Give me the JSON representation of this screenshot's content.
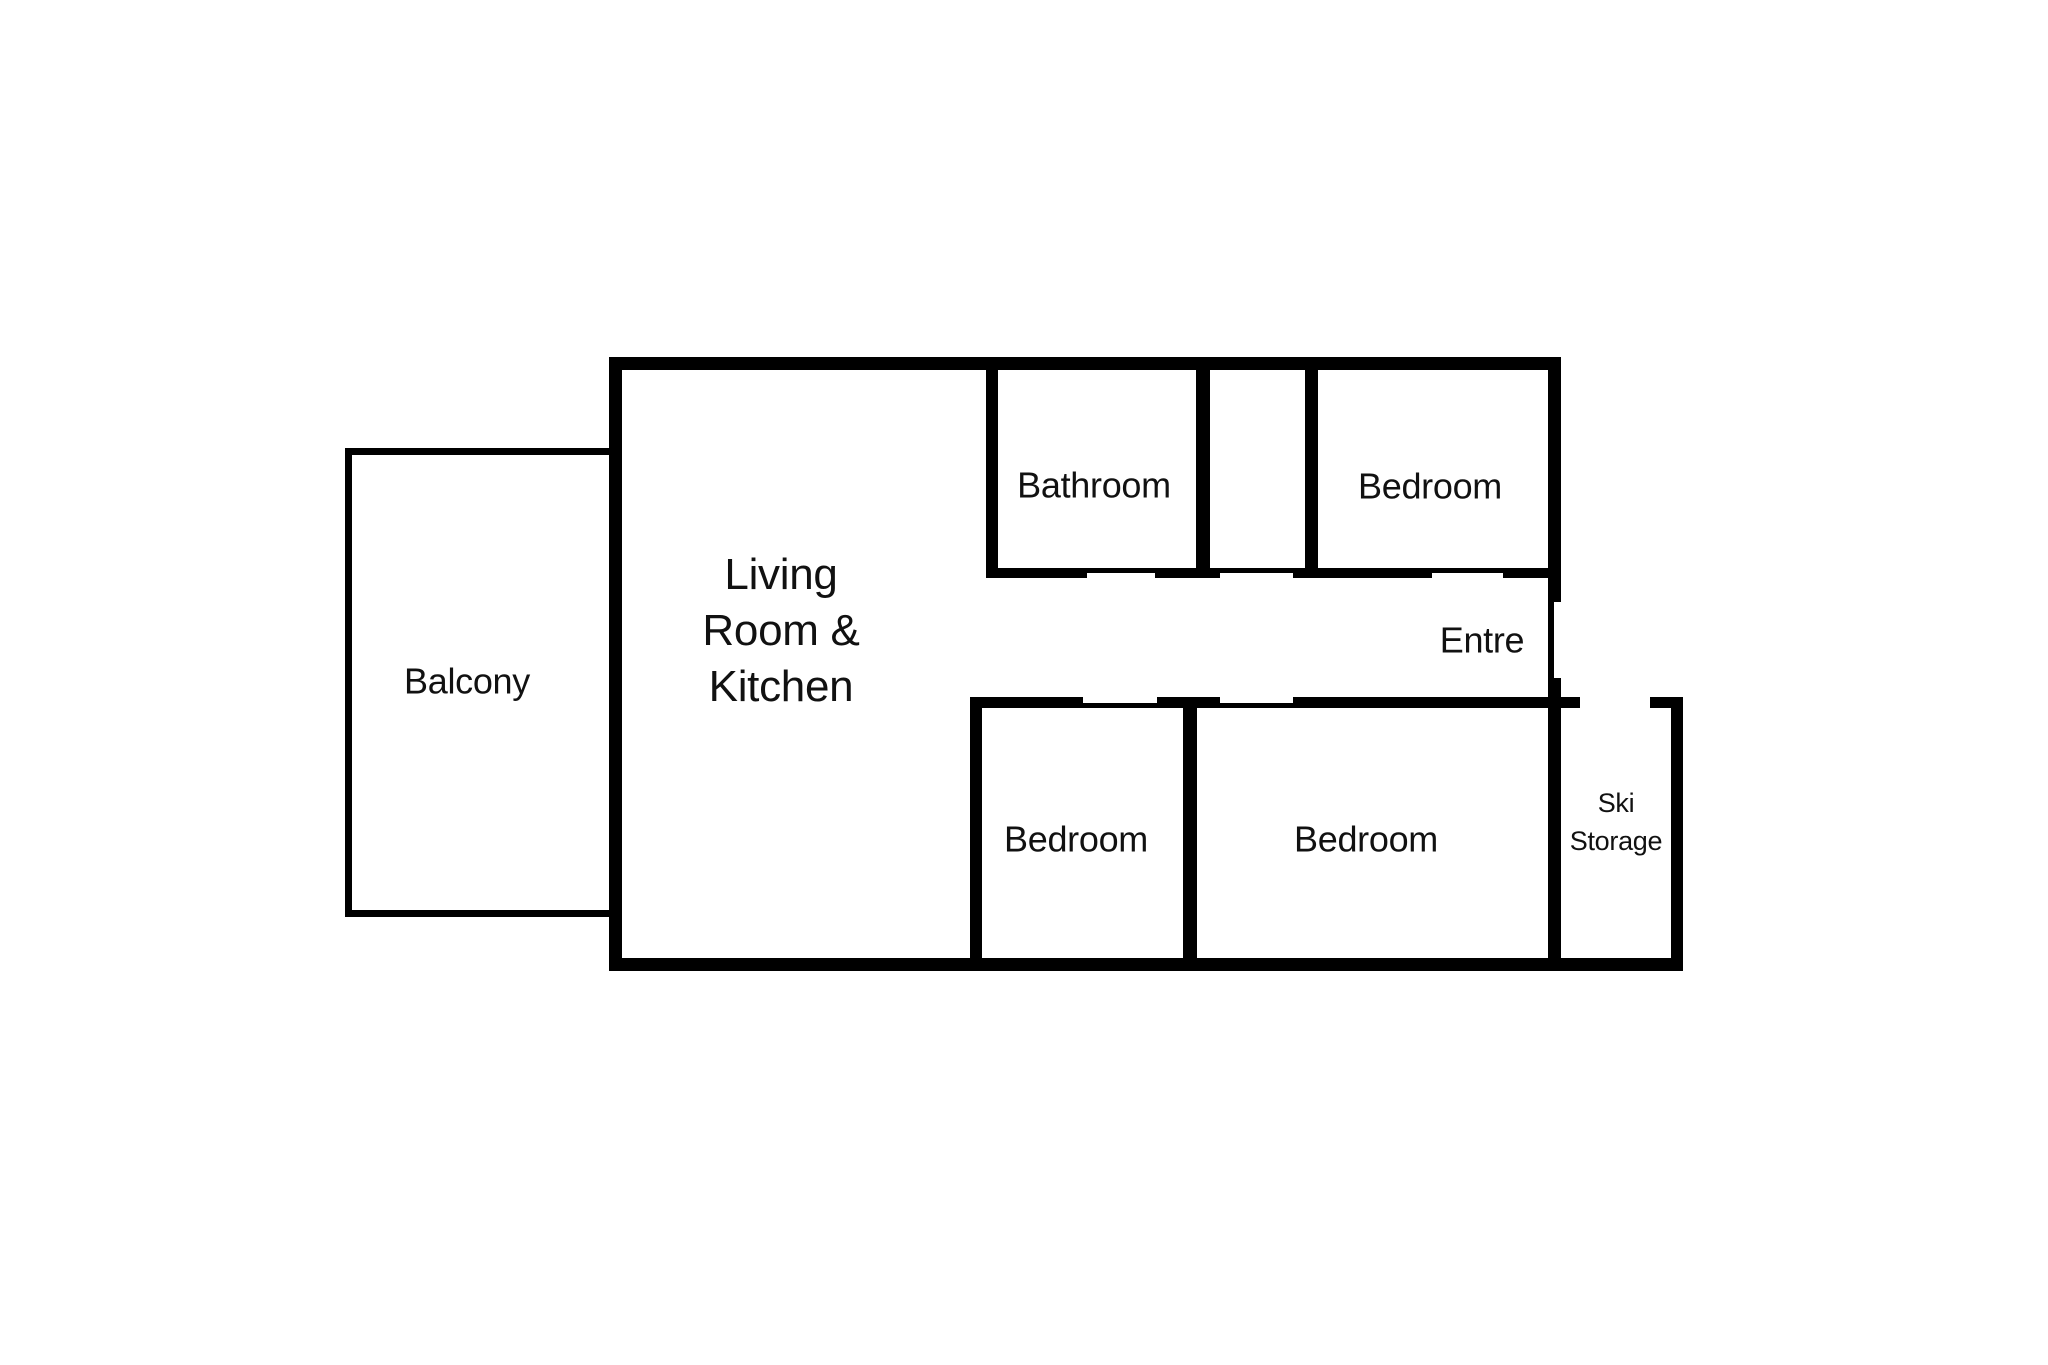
{
  "canvas": {
    "background_color": "#ffffff",
    "wall_color": "#000000",
    "text_color": "#111111"
  },
  "rooms": {
    "balcony": {
      "label": "Balcony"
    },
    "living_room_kitchen": {
      "lines": [
        "Living",
        "Room &",
        "Kitchen"
      ]
    },
    "bathroom": {
      "label": "Bathroom"
    },
    "bedroom_top": {
      "label": "Bedroom"
    },
    "entre": {
      "label": "Entre"
    },
    "bedroom_bottom_left": {
      "label": "Bedroom"
    },
    "bedroom_bottom_right": {
      "label": "Bedroom"
    },
    "ski_storage": {
      "lines": [
        "Ski",
        "Storage"
      ]
    }
  }
}
